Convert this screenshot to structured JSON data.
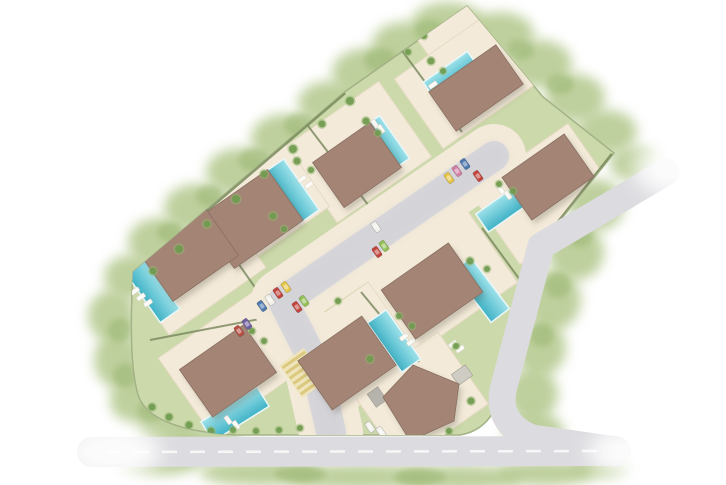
{
  "canvas": {
    "width": 726,
    "height": 485,
    "background": "#ffffff"
  },
  "palette": {
    "veg_base": "#b3c88c",
    "veg_dark": "#9ab672",
    "site_grass": "#ccd9ab",
    "site_edge": "#a3b287",
    "terrace": "#f3ead9",
    "terrace_edge": "#e7dbc5",
    "roof": "#a38475",
    "roof_edge": "#8a6f60",
    "roof_shadow": "rgba(90,78,68,0.28)",
    "pool_light": "#9fe2ea",
    "pool_dark": "#3fb2c6",
    "pool_rim": "#eaf7f8",
    "road_inner": "#d9d8dc",
    "road_outer": "#dcdbdf",
    "road_edge": "#c9c8cc",
    "hedge": "#76865c",
    "boundary_hedge": "#7e8f60",
    "shrub": "#6e9a4e",
    "shrub_halo": "#98b873",
    "lounger": "#fbfaf7",
    "lounger_edge": "#d8d2c6",
    "ramp_base": "#efe5bb",
    "ramp_stripe": "#dcc87e",
    "shed_gray": "#b7b4ae",
    "pad_gray": "#cfccc4",
    "marking_white": "#f7f7f7",
    "fade_white": "#ffffff"
  },
  "vegetation": {
    "blobs": [
      [
        368,
        72,
        36,
        24
      ],
      [
        404,
        44,
        32,
        22
      ],
      [
        448,
        22,
        36,
        20
      ],
      [
        500,
        34,
        34,
        22
      ],
      [
        540,
        64,
        32,
        24
      ],
      [
        575,
        98,
        30,
        24
      ],
      [
        607,
        132,
        30,
        22
      ],
      [
        636,
        164,
        26,
        18
      ],
      [
        330,
        103,
        32,
        22
      ],
      [
        285,
        138,
        34,
        24
      ],
      [
        240,
        172,
        34,
        24
      ],
      [
        196,
        208,
        32,
        24
      ],
      [
        158,
        242,
        30,
        24
      ],
      [
        130,
        277,
        26,
        22
      ],
      [
        112,
        316,
        24,
        26
      ],
      [
        118,
        360,
        24,
        28
      ],
      [
        136,
        400,
        26,
        26
      ],
      [
        168,
        428,
        30,
        22
      ],
      [
        210,
        444,
        32,
        18
      ],
      [
        260,
        473,
        60,
        13
      ],
      [
        360,
        477,
        72,
        13
      ],
      [
        460,
        478,
        62,
        13
      ],
      [
        545,
        473,
        48,
        13
      ],
      [
        160,
        462,
        42,
        13
      ],
      [
        600,
        466,
        30,
        12
      ],
      [
        596,
        205,
        28,
        26
      ],
      [
        576,
        252,
        28,
        28
      ],
      [
        553,
        300,
        28,
        30
      ],
      [
        540,
        348,
        26,
        28
      ],
      [
        532,
        394,
        26,
        26
      ],
      [
        534,
        432,
        30,
        20
      ]
    ],
    "spots": [
      [
        380,
        60,
        16,
        12
      ],
      [
        430,
        30,
        16,
        10
      ],
      [
        520,
        50,
        14,
        10
      ],
      [
        560,
        84,
        14,
        10
      ],
      [
        300,
        125,
        16,
        12
      ],
      [
        255,
        160,
        16,
        12
      ],
      [
        210,
        196,
        14,
        11
      ],
      [
        170,
        232,
        13,
        10
      ],
      [
        120,
        330,
        12,
        12
      ],
      [
        125,
        375,
        12,
        12
      ],
      [
        150,
        412,
        13,
        11
      ],
      [
        580,
        235,
        13,
        12
      ],
      [
        558,
        285,
        13,
        13
      ],
      [
        542,
        335,
        12,
        12
      ],
      [
        300,
        474,
        26,
        8
      ],
      [
        420,
        477,
        26,
        8
      ]
    ]
  },
  "site": {
    "outline": "M 467 6 L 543 97 L 614 153 L 538 248 L 500 396 Q 490 430 460 435 L 235 435 Q 150 430 138 395 Q 128 360 133 272 L 346 91 Z"
  },
  "terraces": [
    {
      "cx": 463,
      "cy": 42,
      "w": 72,
      "h": 68,
      "rot": -35
    },
    {
      "cx": 470,
      "cy": 78,
      "w": 125,
      "h": 85,
      "rot": -35
    },
    {
      "cx": 358,
      "cy": 152,
      "w": 115,
      "h": 92,
      "rot": -35
    },
    {
      "cx": 544,
      "cy": 194,
      "w": 120,
      "h": 88,
      "rot": -35
    },
    {
      "cx": 252,
      "cy": 202,
      "w": 122,
      "h": 96,
      "rot": -35
    },
    {
      "cx": 190,
      "cy": 262,
      "w": 118,
      "h": 96,
      "rot": -35
    },
    {
      "cx": 233,
      "cy": 362,
      "w": 118,
      "h": 92,
      "rot": -35
    },
    {
      "cx": 352,
      "cy": 352,
      "w": 122,
      "h": 96,
      "rot": -35
    },
    {
      "cx": 440,
      "cy": 278,
      "w": 122,
      "h": 96,
      "rot": -35
    },
    {
      "cx": 420,
      "cy": 398,
      "w": 105,
      "h": 88,
      "rot": -35
    }
  ],
  "hedges": {
    "lines": [
      [
        400,
        48,
        462,
        132
      ],
      [
        302,
        118,
        372,
        210
      ],
      [
        170,
        166,
        268,
        306
      ],
      [
        150,
        340,
        265,
        318
      ],
      [
        482,
        228,
        523,
        284
      ],
      [
        361,
        292,
        419,
        362
      ]
    ],
    "boundary": [
      [
        612,
        154,
        539,
        246
      ],
      [
        539,
        246,
        501,
        393
      ],
      [
        345,
        93,
        136,
        271
      ]
    ]
  },
  "roads": {
    "spine": {
      "path": "M 494 156 L 283 301 L 316 366 L 331 432",
      "verge_width": 64,
      "width": 30
    },
    "outer": {
      "path": "M 666 172 L 541 246 L 503 390 Q 497 424 532 438 L 616 450",
      "width": 27
    },
    "bottom": {
      "path": "M 92 452 L 616 451",
      "width": 30
    },
    "centerline": {
      "x1": 106,
      "y1": 452,
      "x2": 606,
      "y2": 451,
      "dash": "15 13",
      "width": 2.5
    }
  },
  "crossing": {
    "cx": 303,
    "cy": 373,
    "w": 40,
    "h": 30,
    "rot": 55,
    "stripes": 6
  },
  "pools": [
    {
      "cx": 451,
      "cy": 75,
      "w": 54,
      "h": 20,
      "rot": -35
    },
    {
      "cx": 386,
      "cy": 143,
      "w": 52,
      "h": 21,
      "rot": 55
    },
    {
      "cx": 505,
      "cy": 207,
      "w": 56,
      "h": 22,
      "rot": -35
    },
    {
      "cx": 292,
      "cy": 191,
      "w": 62,
      "h": 23,
      "rot": 55
    },
    {
      "cx": 150,
      "cy": 287,
      "w": 70,
      "h": 24,
      "rot": 55
    },
    {
      "cx": 235,
      "cy": 414,
      "w": 66,
      "h": 23,
      "rot": -32
    },
    {
      "cx": 394,
      "cy": 341,
      "w": 60,
      "h": 23,
      "rot": 55
    },
    {
      "cx": 481,
      "cy": 290,
      "w": 64,
      "h": 23,
      "rot": 53
    }
  ],
  "loungers": [
    [
      433,
      85,
      -35
    ],
    [
      439,
      90,
      -35
    ],
    [
      375,
      124,
      55
    ],
    [
      381,
      129,
      55
    ],
    [
      501,
      190,
      55
    ],
    [
      508,
      195,
      55
    ],
    [
      302,
      179,
      -35
    ],
    [
      309,
      185,
      -35
    ],
    [
      135,
      291,
      -35
    ],
    [
      141,
      297,
      -35
    ],
    [
      148,
      303,
      -35
    ],
    [
      228,
      420,
      55
    ],
    [
      236,
      425,
      55
    ],
    [
      404,
      337,
      -35
    ],
    [
      411,
      342,
      -35
    ],
    [
      453,
      344,
      -35
    ],
    [
      460,
      349,
      -35
    ]
  ],
  "sheds": [
    {
      "cx": 377,
      "cy": 397,
      "w": 13,
      "h": 16,
      "rot": -35,
      "fill": "shed_gray"
    },
    {
      "cx": 462,
      "cy": 375,
      "w": 17,
      "h": 13,
      "rot": -35,
      "fill": "pad_gray"
    }
  ],
  "roofs": {
    "rects": [
      {
        "cx": 476,
        "cy": 88,
        "w": 82,
        "h": 48,
        "rot": -35
      },
      {
        "cx": 357,
        "cy": 165,
        "w": 70,
        "h": 55,
        "rot": -35
      },
      {
        "cx": 548,
        "cy": 177,
        "w": 76,
        "h": 52,
        "rot": -35
      },
      {
        "cx": 251,
        "cy": 219,
        "w": 84,
        "h": 62,
        "rot": -35
      },
      {
        "cx": 188,
        "cy": 253,
        "w": 80,
        "h": 62,
        "rot": -35
      },
      {
        "cx": 228,
        "cy": 371,
        "w": 78,
        "h": 58,
        "rot": -35
      },
      {
        "cx": 347,
        "cy": 363,
        "w": 78,
        "h": 60,
        "rot": -35
      },
      {
        "cx": 432,
        "cy": 291,
        "w": 82,
        "h": 60,
        "rot": -35
      }
    ],
    "pentagon": "383,397 413,365 459,384 454,421 410,441"
  },
  "shrubs": [
    [
      350,
      101,
      4
    ],
    [
      322,
      124,
      3.5
    ],
    [
      293,
      149,
      4
    ],
    [
      264,
      174,
      3.5
    ],
    [
      236,
      199,
      4
    ],
    [
      207,
      224,
      3.5
    ],
    [
      179,
      249,
      4
    ],
    [
      153,
      271,
      3.5
    ],
    [
      297,
      161,
      3.5
    ],
    [
      311,
      170,
      3
    ],
    [
      273,
      216,
      3.5
    ],
    [
      284,
      229,
      3
    ],
    [
      366,
      121,
      3.5
    ],
    [
      378,
      133,
      3
    ],
    [
      431,
      61,
      3.5
    ],
    [
      443,
      71,
      3
    ],
    [
      499,
      184,
      3
    ],
    [
      513,
      191,
      3
    ],
    [
      470,
      261,
      3.5
    ],
    [
      487,
      269,
      3
    ],
    [
      399,
      316,
      3
    ],
    [
      412,
      326,
      3
    ],
    [
      338,
      301,
      3
    ],
    [
      252,
      331,
      3
    ],
    [
      264,
      341,
      3
    ],
    [
      370,
      359,
      3.5
    ],
    [
      456,
      346,
      3
    ],
    [
      471,
      401,
      3.5
    ],
    [
      449,
      431,
      3
    ],
    [
      152,
      407,
      3.5
    ],
    [
      169,
      417,
      3.5
    ],
    [
      189,
      425,
      3.5
    ],
    [
      211,
      431,
      3.5
    ],
    [
      233,
      430,
      3
    ],
    [
      256,
      431,
      3
    ],
    [
      279,
      430,
      3
    ],
    [
      300,
      428,
      3
    ],
    [
      561,
      231,
      3
    ],
    [
      546,
      266,
      3
    ],
    [
      531,
      301,
      3
    ],
    [
      517,
      336,
      3
    ],
    [
      509,
      366,
      3
    ],
    [
      424,
      36,
      3
    ],
    [
      408,
      52,
      3
    ]
  ],
  "cars": [
    {
      "x": 449,
      "y": 178,
      "rot": 55,
      "color": "#e5c544"
    },
    {
      "x": 457,
      "y": 171,
      "rot": 55,
      "color": "#d27fa5"
    },
    {
      "x": 465,
      "y": 164,
      "rot": 55,
      "color": "#4d79ae"
    },
    {
      "x": 478,
      "y": 176,
      "rot": 55,
      "color": "#c2443c"
    },
    {
      "x": 376,
      "y": 227,
      "rot": 55,
      "color": "#f1efe9"
    },
    {
      "x": 377,
      "y": 252,
      "rot": 55,
      "color": "#c2443c"
    },
    {
      "x": 384,
      "y": 246,
      "rot": 55,
      "color": "#92c055"
    },
    {
      "x": 262,
      "y": 306,
      "rot": 55,
      "color": "#4d79ae"
    },
    {
      "x": 270,
      "y": 300,
      "rot": 55,
      "color": "#f1efe9"
    },
    {
      "x": 278,
      "y": 293,
      "rot": 55,
      "color": "#c2443c"
    },
    {
      "x": 286,
      "y": 287,
      "rot": 55,
      "color": "#e5c544"
    },
    {
      "x": 297,
      "y": 307,
      "rot": 55,
      "color": "#c2443c"
    },
    {
      "x": 304,
      "y": 301,
      "rot": 55,
      "color": "#92c055"
    },
    {
      "x": 239,
      "y": 331,
      "rot": 55,
      "color": "#b84f43"
    },
    {
      "x": 247,
      "y": 324,
      "rot": 55,
      "color": "#6f5fa0"
    },
    {
      "x": 370,
      "y": 427,
      "rot": 55,
      "color": "#f4f2ee"
    },
    {
      "x": 381,
      "y": 432,
      "rot": 55,
      "color": "#f4f2ee"
    }
  ],
  "fades": [
    [
      112,
      452,
      48,
      28
    ],
    [
      640,
      452,
      52,
      26
    ],
    [
      676,
      168,
      42,
      28
    ]
  ]
}
